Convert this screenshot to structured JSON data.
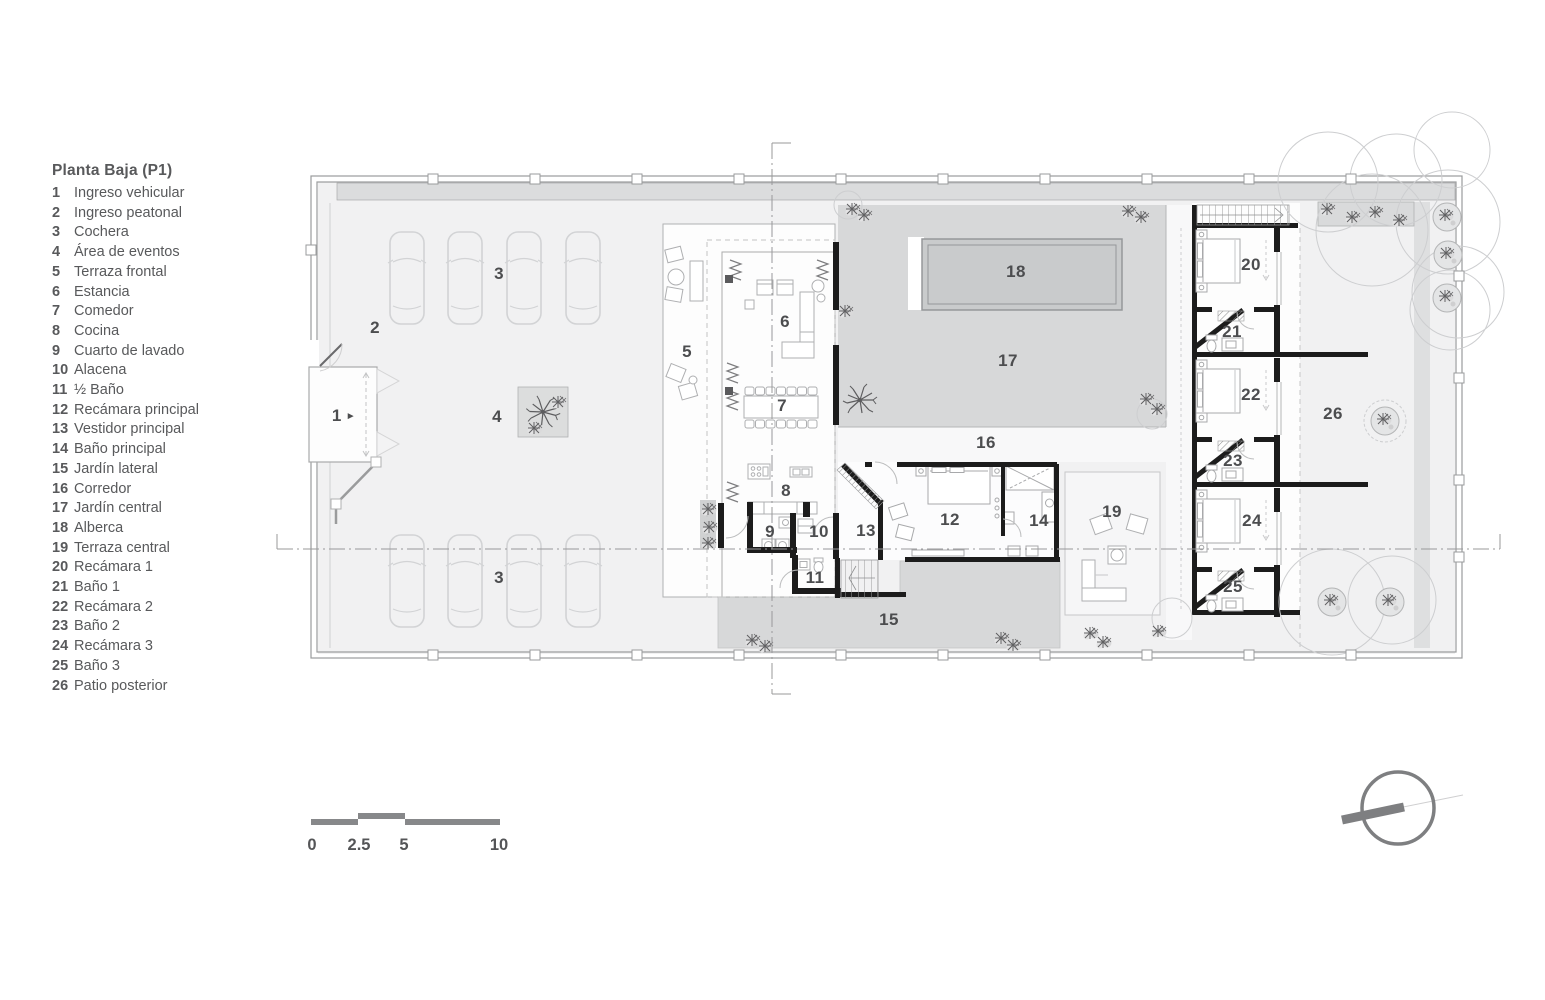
{
  "title": "Planta Baja (P1)",
  "legend": {
    "items": [
      {
        "num": "1",
        "name": "Ingreso vehicular"
      },
      {
        "num": "2",
        "name": "Ingreso peatonal"
      },
      {
        "num": "3",
        "name": "Cochera"
      },
      {
        "num": "4",
        "name": "Área de eventos"
      },
      {
        "num": "5",
        "name": "Terraza frontal"
      },
      {
        "num": "6",
        "name": "Estancia"
      },
      {
        "num": "7",
        "name": "Comedor"
      },
      {
        "num": "8",
        "name": "Cocina"
      },
      {
        "num": "9",
        "name": "Cuarto de lavado"
      },
      {
        "num": "10",
        "name": "Alacena"
      },
      {
        "num": "11",
        "name": "½ Baño"
      },
      {
        "num": "12",
        "name": "Recámara principal"
      },
      {
        "num": "13",
        "name": "Vestidor principal"
      },
      {
        "num": "14",
        "name": "Baño principal"
      },
      {
        "num": "15",
        "name": "Jardín lateral"
      },
      {
        "num": "16",
        "name": "Corredor"
      },
      {
        "num": "17",
        "name": "Jardín central"
      },
      {
        "num": "18",
        "name": "Alberca"
      },
      {
        "num": "19",
        "name": "Terraza central"
      },
      {
        "num": "20",
        "name": "Recámara 1"
      },
      {
        "num": "21",
        "name": "Baño 1"
      },
      {
        "num": "22",
        "name": "Recámara 2"
      },
      {
        "num": "23",
        "name": "Baño 2"
      },
      {
        "num": "24",
        "name": "Recámara 3"
      },
      {
        "num": "25",
        "name": "Baño 3"
      },
      {
        "num": "26",
        "name": "Patio posterior"
      }
    ]
  },
  "plan": {
    "entry_arrow": "►"
  },
  "scale_bar": {
    "ticks": [
      "0",
      "2.5",
      "5",
      "10"
    ]
  },
  "colors": {
    "black_wall": "#1c1c1c",
    "floor": "#f1f1f2",
    "garden": "#d7d8d9",
    "pool": "#c9cbcc",
    "legend_text": "#58595b",
    "label_text": "#4c4d4f",
    "scale_bar": "#87888a",
    "north": "#7e7f81"
  }
}
